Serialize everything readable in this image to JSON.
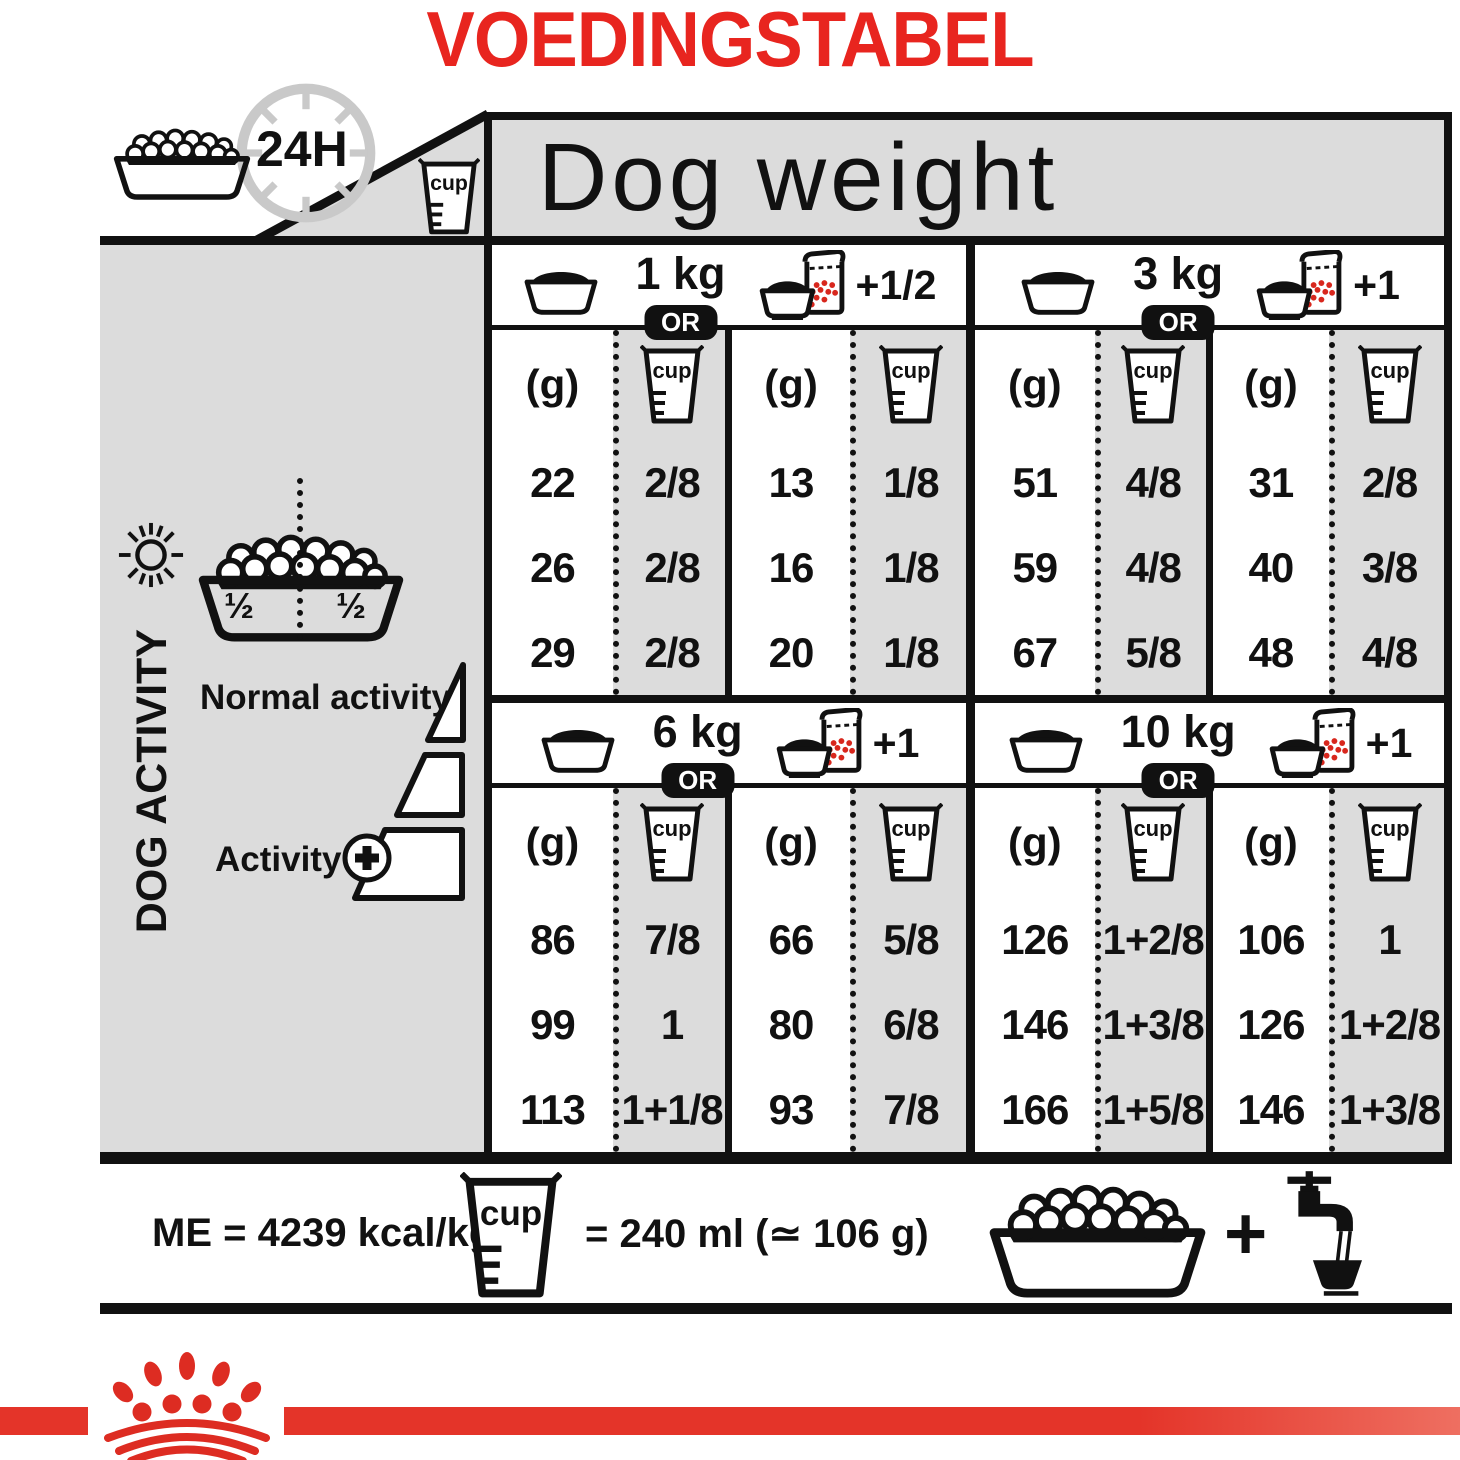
{
  "page": {
    "title": "VOEDINGSTABEL"
  },
  "header": {
    "duration": "24H",
    "dog_weight": "Dog weight"
  },
  "icons": {
    "cup_label": "cup",
    "names": [
      "food-bowl-icon",
      "clock-24h-icon",
      "measuring-cup-icon",
      "dry-bowl-icon",
      "wet-pouch-icon",
      "sun-icon",
      "moon-icon",
      "plus-circle-icon",
      "tap-water-icon",
      "royal-canin-crown-icon"
    ]
  },
  "sidebar": {
    "dog_activity": "DOG ACTIVITY",
    "half_left": "½",
    "half_right": "½",
    "normal_activity": "Normal activity",
    "activity": "Activity",
    "activity_plus": "+"
  },
  "table": {
    "or_label": "OR",
    "gram_header": "(g)",
    "sections": [
      {
        "weight": "1 kg",
        "mixed_add": "+1/2",
        "dry": {
          "g": [
            "22",
            "26",
            "29"
          ],
          "cup": [
            "2/8",
            "2/8",
            "2/8"
          ]
        },
        "mixed": {
          "g": [
            "13",
            "16",
            "20"
          ],
          "cup": [
            "1/8",
            "1/8",
            "1/8"
          ]
        }
      },
      {
        "weight": "3 kg",
        "mixed_add": "+1",
        "dry": {
          "g": [
            "51",
            "59",
            "67"
          ],
          "cup": [
            "4/8",
            "4/8",
            "5/8"
          ]
        },
        "mixed": {
          "g": [
            "31",
            "40",
            "48"
          ],
          "cup": [
            "2/8",
            "3/8",
            "4/8"
          ]
        }
      },
      {
        "weight": "6 kg",
        "mixed_add": "+1",
        "dry": {
          "g": [
            "86",
            "99",
            "113"
          ],
          "cup": [
            "7/8",
            "1",
            "1+1/8"
          ]
        },
        "mixed": {
          "g": [
            "66",
            "80",
            "93"
          ],
          "cup": [
            "5/8",
            "6/8",
            "7/8"
          ]
        }
      },
      {
        "weight": "10 kg",
        "mixed_add": "+1",
        "dry": {
          "g": [
            "126",
            "146",
            "166"
          ],
          "cup": [
            "1+2/8",
            "1+3/8",
            "1+5/8"
          ]
        },
        "mixed": {
          "g": [
            "106",
            "126",
            "146"
          ],
          "cup": [
            "1",
            "1+2/8",
            "1+3/8"
          ]
        }
      }
    ]
  },
  "footer": {
    "me": "ME = 4239 kcal/kg",
    "cup_equals": "= 240 ml (≃ 106 g)",
    "plus": "+"
  },
  "colors": {
    "brand_red": "#e8251f",
    "band_red": "#e43429",
    "panel_gray": "#dcdcdc",
    "ink_black": "#111111",
    "kibble_red": "#d8271d"
  },
  "chart_data": {
    "type": "table",
    "title": "VOEDINGSTABEL",
    "subtitle": "Dog weight feeding guide (per 24H)",
    "row_labels": [
      "Activity low (normal activity row 1)",
      "Normal activity",
      "Activity +"
    ],
    "columns": [
      "dog_weight",
      "dry_only_g",
      "dry_only_cup",
      "dry_plus_wet_g",
      "dry_plus_wet_cup",
      "wet_pouches_added"
    ],
    "rows": [
      {
        "dog_weight": "1 kg",
        "dry_g": [
          22,
          26,
          29
        ],
        "dry_cup": [
          "2/8",
          "2/8",
          "2/8"
        ],
        "mixed_g": [
          13,
          16,
          20
        ],
        "mixed_cup": [
          "1/8",
          "1/8",
          "1/8"
        ],
        "wet_added": "+1/2"
      },
      {
        "dog_weight": "3 kg",
        "dry_g": [
          51,
          59,
          67
        ],
        "dry_cup": [
          "4/8",
          "4/8",
          "5/8"
        ],
        "mixed_g": [
          31,
          40,
          48
        ],
        "mixed_cup": [
          "2/8",
          "3/8",
          "4/8"
        ],
        "wet_added": "+1"
      },
      {
        "dog_weight": "6 kg",
        "dry_g": [
          86,
          99,
          113
        ],
        "dry_cup": [
          "7/8",
          "1",
          "1+1/8"
        ],
        "mixed_g": [
          66,
          80,
          93
        ],
        "mixed_cup": [
          "5/8",
          "6/8",
          "7/8"
        ],
        "wet_added": "+1"
      },
      {
        "dog_weight": "10 kg",
        "dry_g": [
          126,
          146,
          166
        ],
        "dry_cup": [
          "1+2/8",
          "1+3/8",
          "1+5/8"
        ],
        "mixed_g": [
          106,
          126,
          146
        ],
        "mixed_cup": [
          "1",
          "1+2/8",
          "1+3/8"
        ],
        "wet_added": "+1"
      }
    ],
    "notes": [
      "ME = 4239 kcal/kg",
      "1 cup = 240 ml (≃ 106 g)",
      "Split ration ½ morning / ½ evening",
      "Serve with fresh water"
    ]
  }
}
